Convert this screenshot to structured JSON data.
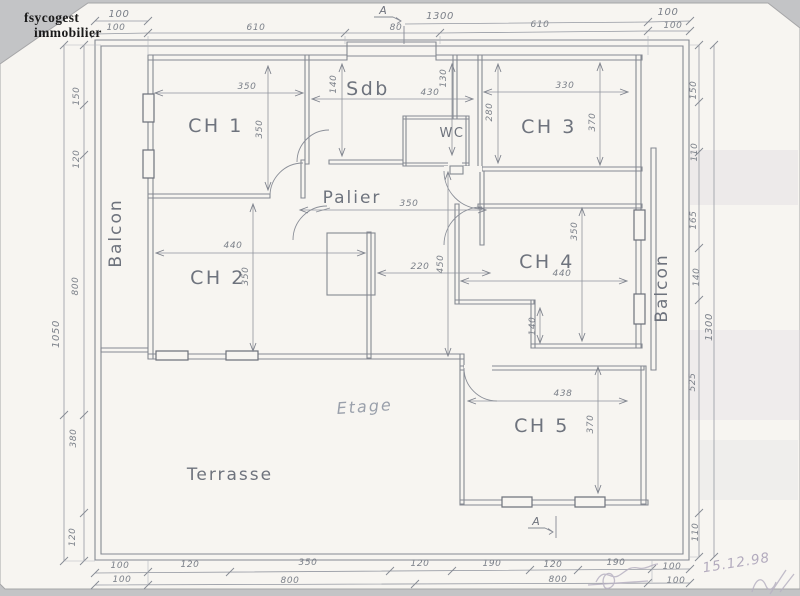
{
  "logo": {
    "line1": "fsycogest",
    "line2": "immobilier"
  },
  "date_note": "15.12.98",
  "section_marker": {
    "top": "A",
    "bottom": "A"
  },
  "rooms": {
    "ch1": "CH 1",
    "sdb": "Sdb",
    "wc": "WC",
    "ch3": "CH 3",
    "palier": "Palier",
    "ch2": "CH 2",
    "ch4": "CH 4",
    "ch5": "CH 5",
    "balcon_left": "Balcon",
    "balcon_right": "Balcon",
    "terrasse": "Terrasse",
    "etage": "Etage"
  },
  "dims": {
    "top_row1": [
      "100",
      "1300",
      "100"
    ],
    "top_row2": [
      "100",
      "610",
      "80",
      "610",
      "100"
    ],
    "left_outer": "1050",
    "left_inner": [
      "150",
      "120",
      "800",
      "380",
      "120"
    ],
    "right_inner": [
      "150",
      "110",
      "165",
      "140",
      "525",
      "110"
    ],
    "right_outer": "1300",
    "bottom_row1": [
      "100",
      "120",
      "350",
      "120",
      "190",
      "120",
      "190",
      "100"
    ],
    "bottom_row2": [
      "100",
      "800",
      "800",
      "100"
    ],
    "ch1": {
      "width": "350",
      "height": "350"
    },
    "sdb": {
      "left": "140",
      "width": "430",
      "right": "130"
    },
    "ch3": {
      "left": "280",
      "width": "330",
      "height": "370"
    },
    "palier": {
      "width": "350",
      "height": "450",
      "width2": "220"
    },
    "ch2": {
      "width": "440",
      "height": "350"
    },
    "ch4": {
      "width": "440",
      "height": "350",
      "nook": "140"
    },
    "ch5": {
      "width": "438",
      "height": "370"
    }
  },
  "colors": {
    "pencil": "#858992",
    "paper": "#f7f5f1",
    "logo_ink": "#1a1a1a"
  }
}
